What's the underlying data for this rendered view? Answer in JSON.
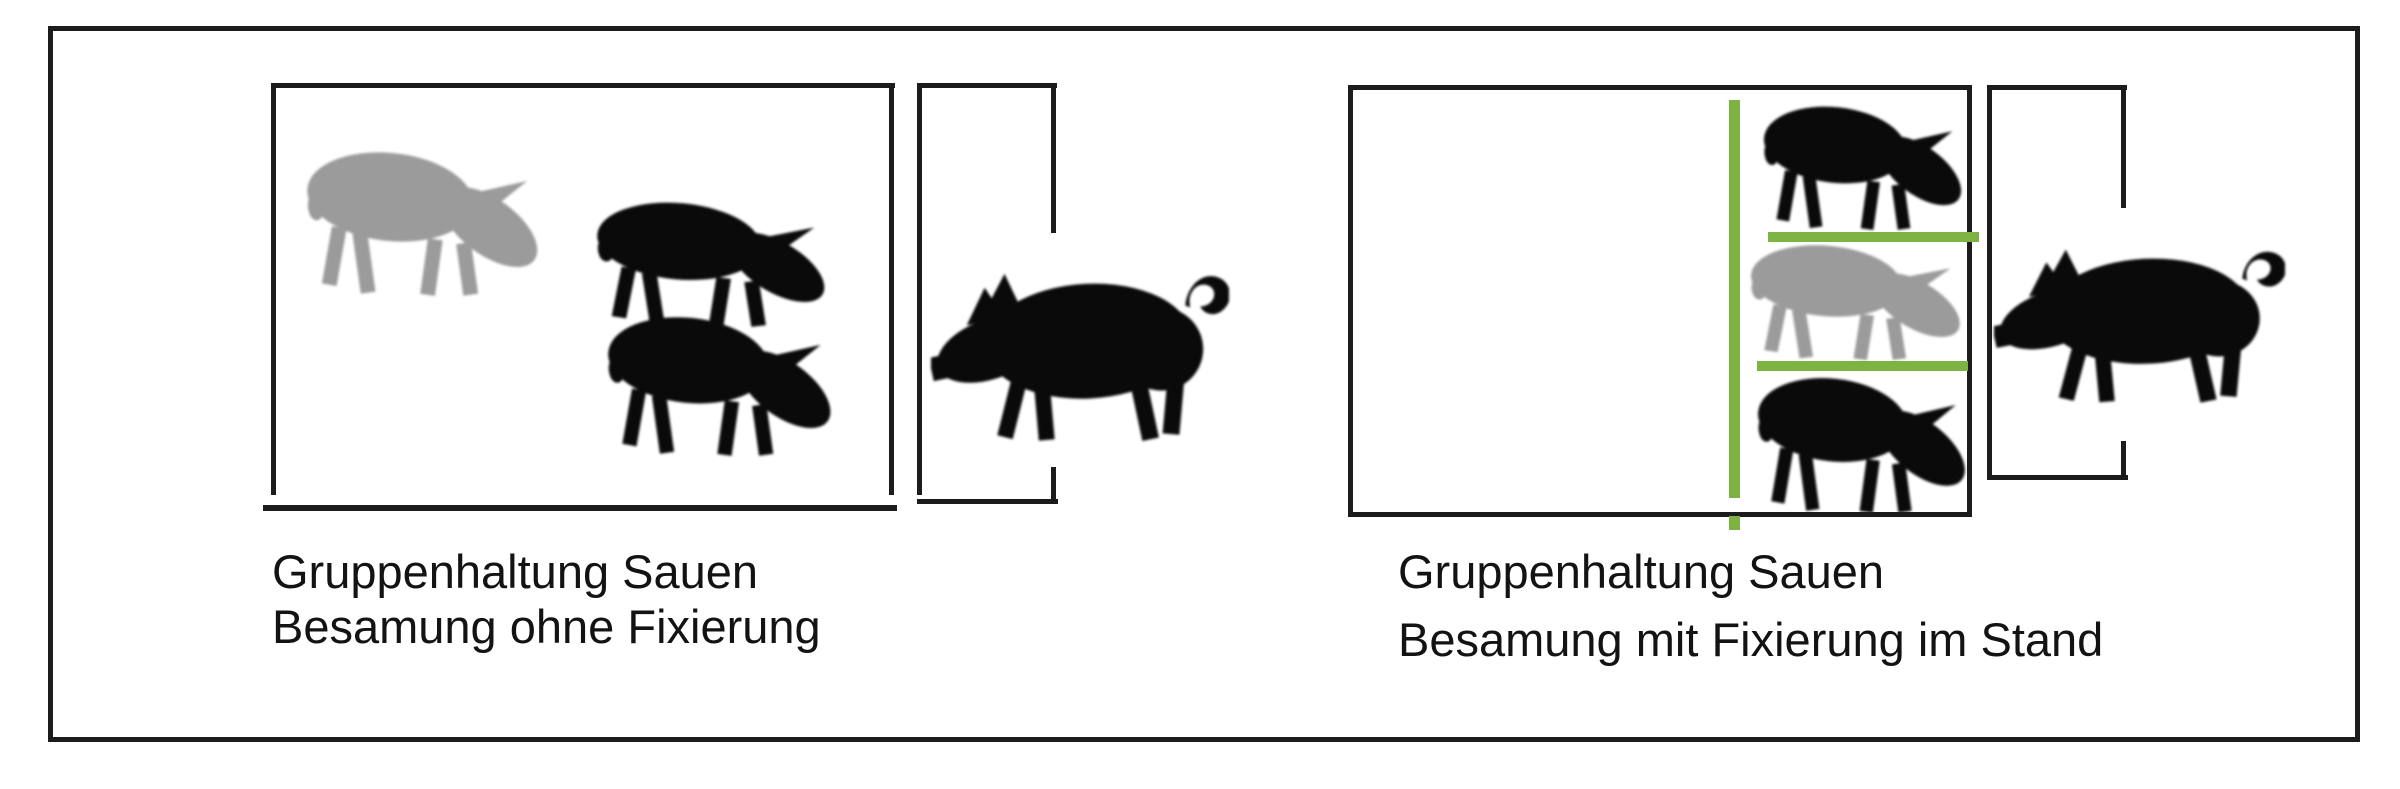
{
  "panels": [
    {
      "id": "left",
      "caption_line1": "Gruppenhaltung Sauen",
      "caption_line2": "Besamung ohne Fixierung",
      "pen_pigs": [
        "gray-sow",
        "black-sow",
        "black-sow"
      ],
      "boar": "black-boar",
      "fixation_stand": false
    },
    {
      "id": "right",
      "caption_line1": "Gruppenhaltung Sauen",
      "caption_line2": "Besamung mit Fixierung im Stand",
      "pen_pigs": [
        "black-sow",
        "gray-sow",
        "black-sow"
      ],
      "boar": "black-boar",
      "fixation_stand": true
    }
  ],
  "icons": {
    "sow": "rooting-sow-silhouette-icon",
    "boar": "standing-boar-silhouette-icon"
  },
  "colors": {
    "outline_black": "#1c1c1c",
    "pig_black": "#0a0a0a",
    "pig_gray": "#9b9b9b",
    "fixation_green": "#7cb342",
    "background": "#ffffff",
    "caption_text": "#131313"
  }
}
